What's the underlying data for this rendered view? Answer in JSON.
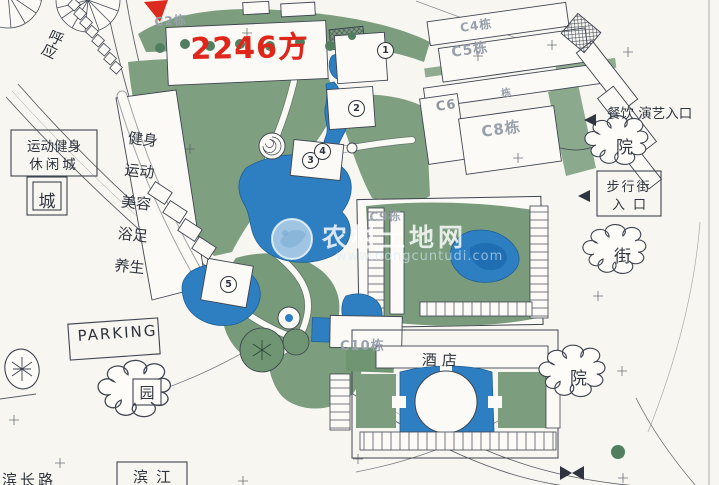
{
  "annotations": {
    "area_label": "2246方",
    "echo_note": "呼应",
    "sport_box_line1": "运动健身",
    "sport_box_line2": "休闲城",
    "cheng_bubble": "城",
    "spa_rows": [
      "健身",
      "运动",
      "美容",
      "浴足",
      "养生"
    ],
    "dining_entrance": "餐饮 演艺入口",
    "yard_bubble_top": "院",
    "walk_street_line1": "步行街",
    "walk_street_line2": "入口",
    "street_bubble": "街",
    "yard_bubble_bottom": "院",
    "parking": "PARKING",
    "garden_bubble": "园",
    "riverside": "滨江",
    "hotel": "酒店",
    "road_partial": "滨长路"
  },
  "building_labels": {
    "c2": "C2栋",
    "c4": "C4栋",
    "c5": "C5栋",
    "dong_fragment": "栋",
    "c6": "C6",
    "c8": "C8栋",
    "c9": "C9栋",
    "c10": "C10栋"
  },
  "circle_markers": [
    "1",
    "2",
    "3",
    "4",
    "5"
  ],
  "watermark": {
    "site_name": "农村土地网",
    "site_url": "www.nongcuntudi.com"
  },
  "colors": {
    "red_accent": "#dc2a1e",
    "water_blue": "#2e7fc2",
    "landscape_green": "#7c9e7e",
    "ink": "#3e4450",
    "cad_gray": "#98a0ab"
  }
}
